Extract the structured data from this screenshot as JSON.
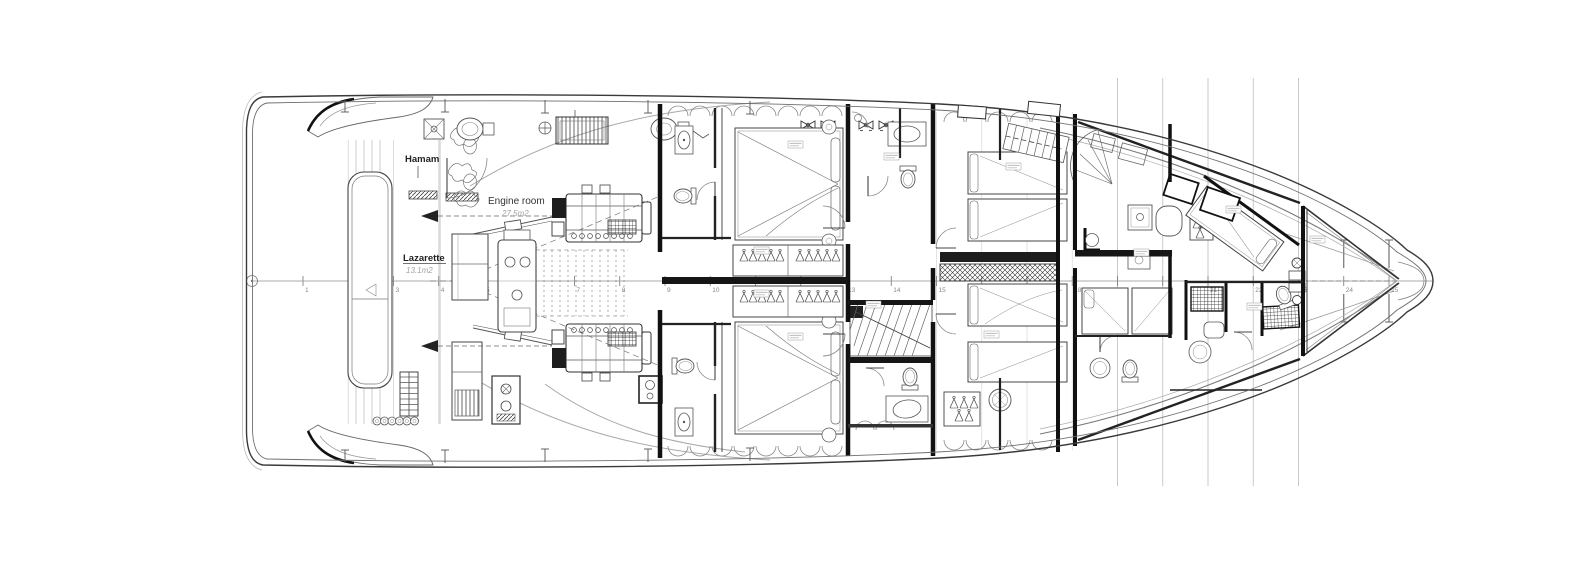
{
  "drawing": {
    "rooms": {
      "hamam": {
        "label": "Hamam"
      },
      "engine_room": {
        "label": "Engine room",
        "area": "27.5m2"
      },
      "lazarette": {
        "label": "Lazarette",
        "area": "13.1m2"
      }
    },
    "stations": {
      "numbers": [
        1,
        2,
        3,
        4,
        5,
        6,
        7,
        8,
        9,
        10,
        11,
        12,
        13,
        14,
        15,
        16,
        17,
        18,
        19,
        20,
        21,
        22,
        23,
        24,
        25
      ]
    },
    "colors": {
      "ink": "#1c1c1c",
      "medium": "#555555",
      "light": "#999999",
      "faint": "#cccccc",
      "paper": "#ffffff"
    }
  }
}
